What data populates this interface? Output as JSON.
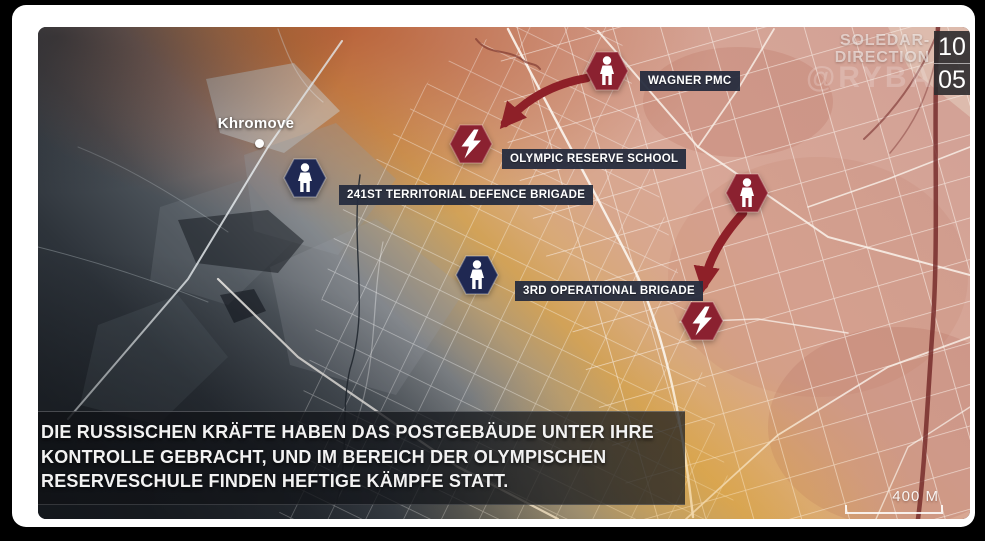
{
  "header": {
    "direction_line1": "SOLEDAR-",
    "direction_line2": "DIRECTION",
    "watermark": "@RYBAR",
    "date": {
      "top": "10",
      "bottom": "05"
    }
  },
  "map": {
    "town_label": "Khromove",
    "unit_labels": {
      "wagner_pmc": "WAGNER PMC",
      "olympic_reserve_school": "OLYMPIC RESERVE SCHOOL",
      "brigade_241": "241ST TERRITORIAL DEFENCE BRIGADE",
      "brigade_3": "3RD OPERATIONAL BRIGADE"
    },
    "markers": [
      {
        "type": "wagner-infantry",
        "icon": "soldier-icon",
        "color": "#8b2130"
      },
      {
        "type": "wagner-infantry",
        "icon": "soldier-icon",
        "color": "#8b2130"
      },
      {
        "type": "clash",
        "icon": "lightning-icon",
        "color": "#8b2130"
      },
      {
        "type": "clash",
        "icon": "lightning-icon",
        "color": "#8b2130"
      },
      {
        "type": "ukrainian-infantry",
        "icon": "soldier-icon",
        "color": "#1f2852"
      },
      {
        "type": "ukrainian-infantry",
        "icon": "soldier-icon",
        "color": "#1f2852"
      }
    ],
    "scale_label": "400 M"
  },
  "caption": {
    "text_lines": [
      "DIE RUSSISCHEN KRÄFTE HABEN DAS POSTGEBÄUDE UNTER IHRE",
      "KONTROLLE GEBRACHT, UND IM BEREICH DER OLYMPISCHEN",
      "RESERVESCHULE FINDEN HEFTIGE KÄMPFE STATT."
    ]
  },
  "colors": {
    "marker_red": "#8b2130",
    "marker_blue": "#1f2852",
    "arrow_red": "#8e2028",
    "label_bg": "#262c3e",
    "front_line_gold": "#d2a258",
    "map_pink": "#d8a697",
    "map_dark": "#2b3138"
  }
}
